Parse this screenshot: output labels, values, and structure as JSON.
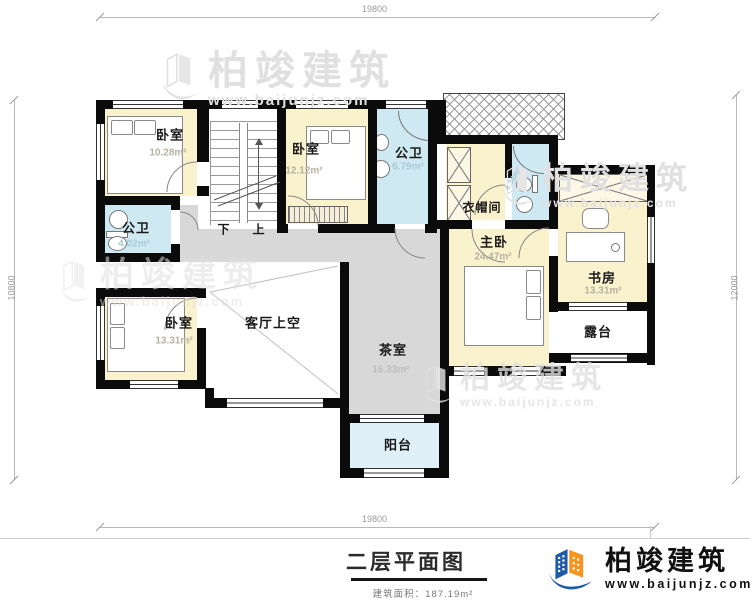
{
  "watermark": {
    "text": "柏竣建筑",
    "url": "www.baijunjz.com"
  },
  "logo": {
    "text": "柏竣建筑",
    "url": "www.baijunjz.com"
  },
  "dims": {
    "top": "19800",
    "bottom": "19800",
    "left": "10800",
    "right": "12000"
  },
  "footer": {
    "title": "二层平面图",
    "area_label": "建筑面积：",
    "area_value": "187.19m²"
  },
  "rooms": {
    "bedroom1": {
      "name": "卧室",
      "area": "10.28m²"
    },
    "bedroom2": {
      "name": "卧室",
      "area": "12.12m²"
    },
    "bedroom3": {
      "name": "卧室",
      "area": "13.31m²"
    },
    "bath_top": {
      "name": "公卫",
      "area": "6.79m²"
    },
    "bath_left": {
      "name": "公卫",
      "area": "4.02m²"
    },
    "bath_master": {
      "area": "4.36m²"
    },
    "cloakroom": {
      "name": "衣帽间"
    },
    "master": {
      "name": "主卧",
      "area": "24.47m²"
    },
    "study": {
      "name": "书房",
      "area": "13.31m²"
    },
    "terrace": {
      "name": "露台"
    },
    "living_void": {
      "name": "客厅上空"
    },
    "tea": {
      "name": "茶室",
      "area": "16.33m²"
    },
    "balcony": {
      "name": "阳台"
    },
    "stairs": {
      "down": "下",
      "up": "上"
    }
  }
}
